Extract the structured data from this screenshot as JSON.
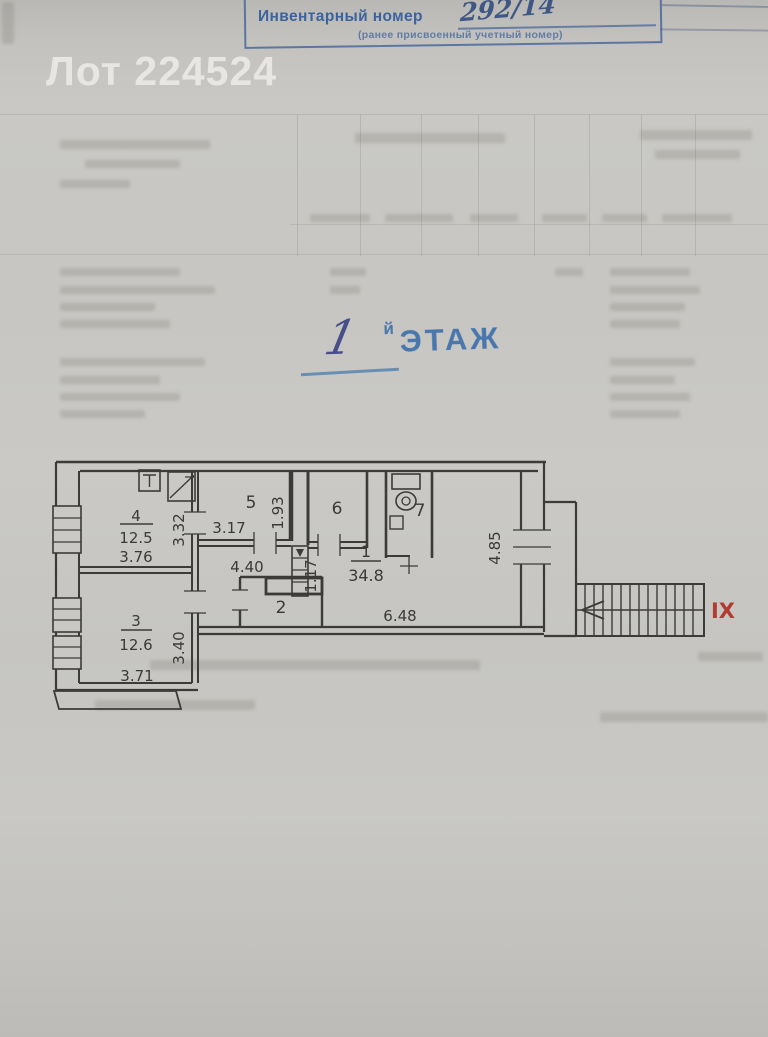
{
  "watermark": {
    "text": "Лот 224524"
  },
  "stamp": {
    "title": "Инвентарный номер",
    "number": "292/14",
    "subtitle": "(ранее присвоенный учетный номер)"
  },
  "floor_title": {
    "handwritten_number": "1",
    "suffix_small": "й",
    "suffix_stamp": "ЭТАЖ"
  },
  "plan": {
    "rooms": {
      "room1": {
        "number": "1",
        "area": "34.8"
      },
      "room2": {
        "number": "2"
      },
      "room3": {
        "number": "3",
        "area": "12.6"
      },
      "room4": {
        "number": "4",
        "area": "12.5"
      },
      "room5": {
        "number": "5"
      },
      "room6": {
        "number": "6"
      },
      "room7": {
        "number": "7"
      }
    },
    "dims": {
      "room4_width": "3.76",
      "room4_height": "3.32",
      "room5_width": "3.17",
      "room5_height": "1.93",
      "duct_height": "1.17",
      "corridor_width": "4.40",
      "room3_width": "3.71",
      "room3_height": "3.40",
      "room1_width": "6.48",
      "room1_height": "4.85"
    },
    "stair_label": "IX"
  },
  "colors": {
    "paper": "#c9c8c4",
    "ink_blue": "#3e71ac",
    "plan_ink": "#3c3b37",
    "stair_red": "#b23b32",
    "watermark": "#e9e8e5"
  }
}
